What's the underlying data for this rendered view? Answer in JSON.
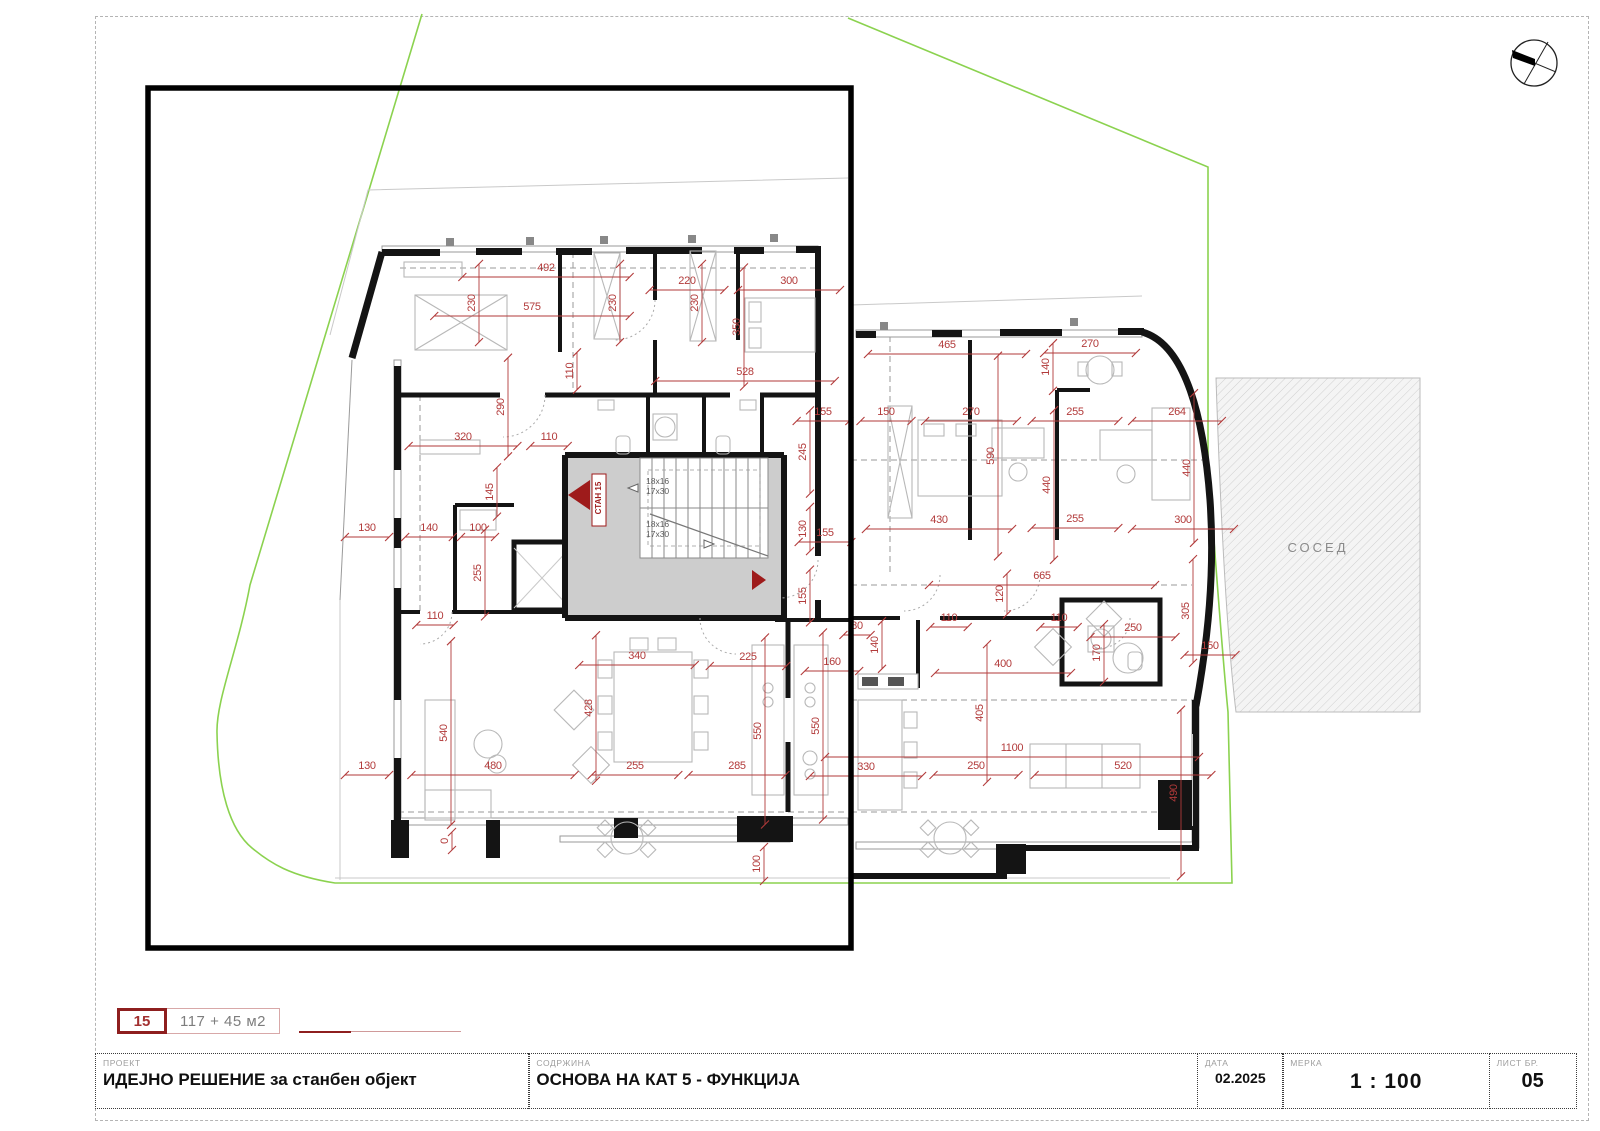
{
  "sheet": {
    "legend": {
      "unit_number": "15",
      "area": "117 + 45 м2"
    },
    "title_block": {
      "project_label": "ПРОЕКТ",
      "project_value": "ИДЕЈНО РЕШЕНИЕ за станбен објект",
      "content_label": "СОДРЖИНА",
      "content_value": "ОСНОВА НА КАТ 5 - ФУНКЦИЈА",
      "date_label": "ДАТА",
      "date_value": "02.2025",
      "scale_label": "МЕРКА",
      "scale_value": "1 : 100",
      "sheet_no_label": "ЛИСТ БР.",
      "sheet_no_value": "05"
    }
  },
  "plan": {
    "unit_marker": "СТАН 15",
    "neighbor_label": "СОСЕД",
    "stair_rise": "18x16",
    "stair_tread": "17x30",
    "colors": {
      "dimension_red": "#b23a3a",
      "marker_dark_red": "#9e1b1b",
      "boundary_green": "#8bd24f",
      "wall_black": "#141414",
      "stair_fill": "#cdcdcd"
    },
    "dim_scale_px_per_cm": 0.34,
    "dimensions": [
      {
        "t": "492",
        "x": 546,
        "y": 271
      },
      {
        "t": "230",
        "x": 475,
        "y": 303,
        "r": 1
      },
      {
        "t": "575",
        "x": 532,
        "y": 310
      },
      {
        "t": "230",
        "x": 616,
        "y": 303,
        "r": 1
      },
      {
        "t": "220",
        "x": 687,
        "y": 284
      },
      {
        "t": "230",
        "x": 698,
        "y": 303,
        "r": 1
      },
      {
        "t": "300",
        "x": 789,
        "y": 284
      },
      {
        "t": "350",
        "x": 740,
        "y": 327,
        "r": 1
      },
      {
        "t": "528",
        "x": 745,
        "y": 375
      },
      {
        "t": "110",
        "x": 573,
        "y": 371,
        "r": 1
      },
      {
        "t": "290",
        "x": 504,
        "y": 407,
        "r": 1
      },
      {
        "t": "320",
        "x": 463,
        "y": 440
      },
      {
        "t": "110",
        "x": 549,
        "y": 440
      },
      {
        "t": "155",
        "x": 823,
        "y": 415
      },
      {
        "t": "245",
        "x": 806,
        "y": 452,
        "r": 1
      },
      {
        "t": "465",
        "x": 947,
        "y": 348
      },
      {
        "t": "270",
        "x": 1090,
        "y": 347
      },
      {
        "t": "140",
        "x": 1049,
        "y": 367,
        "r": 1
      },
      {
        "t": "150",
        "x": 886,
        "y": 415
      },
      {
        "t": "270",
        "x": 971,
        "y": 415
      },
      {
        "t": "255",
        "x": 1075,
        "y": 415
      },
      {
        "t": "264",
        "x": 1177,
        "y": 415
      },
      {
        "t": "590",
        "x": 994,
        "y": 456,
        "r": 1
      },
      {
        "t": "440",
        "x": 1050,
        "y": 485,
        "r": 1
      },
      {
        "t": "440",
        "x": 1190,
        "y": 468,
        "r": 1
      },
      {
        "t": "430",
        "x": 939,
        "y": 523
      },
      {
        "t": "255",
        "x": 1075,
        "y": 522
      },
      {
        "t": "300",
        "x": 1183,
        "y": 523
      },
      {
        "t": "130",
        "x": 806,
        "y": 529,
        "r": 1
      },
      {
        "t": "155",
        "x": 825,
        "y": 536
      },
      {
        "t": "155",
        "x": 806,
        "y": 596,
        "r": 1
      },
      {
        "t": "145",
        "x": 493,
        "y": 492,
        "r": 1
      },
      {
        "t": "130",
        "x": 367,
        "y": 531
      },
      {
        "t": "140",
        "x": 429,
        "y": 531
      },
      {
        "t": "100",
        "x": 478,
        "y": 531
      },
      {
        "t": "255",
        "x": 481,
        "y": 573,
        "r": 1
      },
      {
        "t": "110",
        "x": 435,
        "y": 619
      },
      {
        "t": "665",
        "x": 1042,
        "y": 579
      },
      {
        "t": "120",
        "x": 1003,
        "y": 594,
        "r": 1
      },
      {
        "t": "110",
        "x": 949,
        "y": 621
      },
      {
        "t": "110",
        "x": 1059,
        "y": 621
      },
      {
        "t": "250",
        "x": 1133,
        "y": 631
      },
      {
        "t": "80",
        "x": 857,
        "y": 629
      },
      {
        "t": "140",
        "x": 878,
        "y": 645,
        "r": 1
      },
      {
        "t": "400",
        "x": 1003,
        "y": 667
      },
      {
        "t": "170",
        "x": 1100,
        "y": 653,
        "r": 1
      },
      {
        "t": "150",
        "x": 1210,
        "y": 649
      },
      {
        "t": "305",
        "x": 1189,
        "y": 611,
        "r": 1
      },
      {
        "t": "340",
        "x": 637,
        "y": 659
      },
      {
        "t": "225",
        "x": 748,
        "y": 660
      },
      {
        "t": "160",
        "x": 832,
        "y": 665
      },
      {
        "t": "428",
        "x": 592,
        "y": 708,
        "r": 1
      },
      {
        "t": "540",
        "x": 447,
        "y": 733,
        "r": 1
      },
      {
        "t": "550",
        "x": 761,
        "y": 731,
        "r": 1
      },
      {
        "t": "550",
        "x": 819,
        "y": 726,
        "r": 1
      },
      {
        "t": "405",
        "x": 983,
        "y": 713,
        "r": 1
      },
      {
        "t": "1100",
        "x": 1012,
        "y": 751
      },
      {
        "t": "330",
        "x": 866,
        "y": 770
      },
      {
        "t": "250",
        "x": 976,
        "y": 769
      },
      {
        "t": "520",
        "x": 1123,
        "y": 769
      },
      {
        "t": "490",
        "x": 1177,
        "y": 793,
        "r": 1
      },
      {
        "t": "130",
        "x": 367,
        "y": 769
      },
      {
        "t": "480",
        "x": 493,
        "y": 769
      },
      {
        "t": "255",
        "x": 635,
        "y": 769
      },
      {
        "t": "285",
        "x": 737,
        "y": 769
      },
      {
        "t": "100",
        "x": 760,
        "y": 864,
        "r": 1
      },
      {
        "t": "0",
        "x": 448,
        "y": 841,
        "r": 1
      }
    ]
  }
}
